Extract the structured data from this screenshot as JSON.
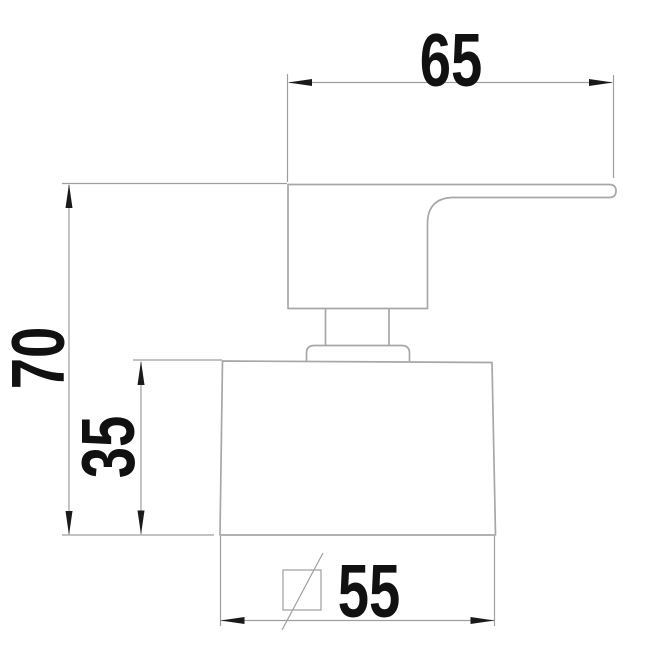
{
  "drawing": {
    "kind": "dimensioned technical drawing - faucet valve handle side view",
    "dimensions": {
      "top_width": "65",
      "overall_height": "70",
      "base_height": "35",
      "base_width": "55"
    },
    "colors": {
      "background": "#ffffff",
      "geometry_line": "#a7a7a7",
      "dimension_line": "#9e9e9e",
      "text": "#111111",
      "arrow": "#1a1a1a"
    },
    "symbols": {
      "square_symbol": "square-with-slash"
    }
  }
}
